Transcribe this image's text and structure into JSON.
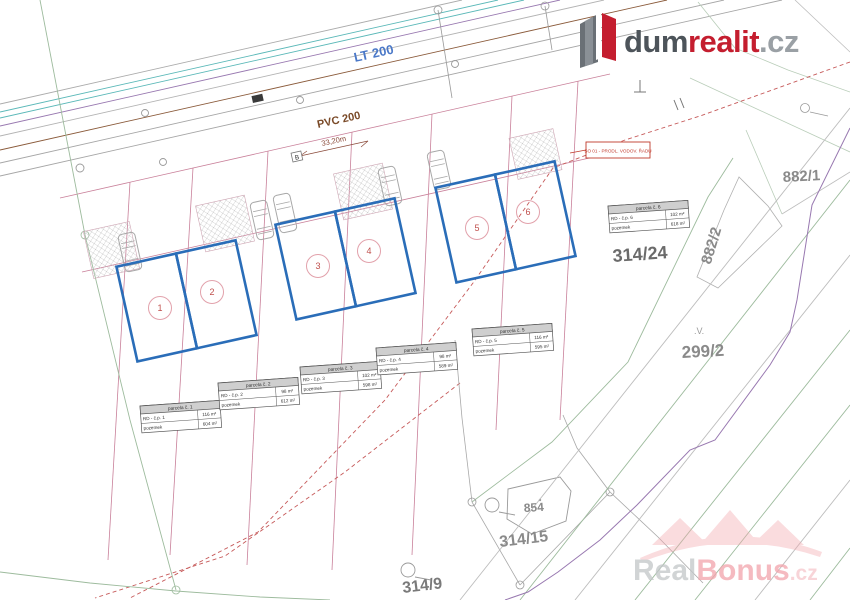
{
  "map": {
    "road_labels": {
      "water_main": "LT 200",
      "sewer_main": "PVC 200",
      "dimension": "33,20m",
      "point_b": "B"
    },
    "red_note": "SO 01 - PRODL. VODOV. ŘADU",
    "parcels": {
      "p882_1": "882/1",
      "p882_2": "882/2",
      "p314_24": "314/24",
      "p299_2": "299/2",
      "p854": "854",
      "p314_15": "314/15",
      "p314_9": "314/9",
      "marker_v": ".V."
    },
    "units": [
      "1",
      "2",
      "3",
      "4",
      "5",
      "6"
    ],
    "tables": [
      {
        "header": "parcela č. 1",
        "rows": [
          [
            "RD - č.p. 1",
            "116 m²"
          ],
          [
            "pozemek",
            "604 m²"
          ]
        ]
      },
      {
        "header": "parcela č. 2",
        "rows": [
          [
            "RD - č.p. 2",
            "98 m²"
          ],
          [
            "pozemek",
            "612 m²"
          ]
        ]
      },
      {
        "header": "parcela č. 3",
        "rows": [
          [
            "RD - č.p. 3",
            "102 m²"
          ],
          [
            "pozemek",
            "598 m²"
          ]
        ]
      },
      {
        "header": "parcela č. 4",
        "rows": [
          [
            "RD - č.p. 4",
            "98 m²"
          ],
          [
            "pozemek",
            "589 m²"
          ]
        ]
      },
      {
        "header": "parcela č. 5",
        "rows": [
          [
            "RD - č.p. 5",
            "116 m²"
          ],
          [
            "pozemek",
            "595 m²"
          ]
        ]
      },
      {
        "header": "parcela č. 6",
        "rows": [
          [
            "RD - č.p. 6",
            "102 m²"
          ],
          [
            "pozemek",
            "618 m²"
          ]
        ]
      }
    ]
  },
  "branding": {
    "logo": {
      "part1": "dum",
      "part2": "realit",
      "part3": ".cz"
    },
    "watermark": {
      "part1": "Real",
      "part2": "Bonus",
      "part3": ".cz"
    }
  },
  "colors": {
    "house_blue": "#2a6db8",
    "parcel_pink": "#c9809a",
    "dashed_red": "#c65a5a",
    "water_teal": "#5ab8b8",
    "sewer_brown": "#8a5a3a",
    "utility_purple": "#9878b0",
    "boundary_green": "#9dbb9d",
    "logo_red": "#c41e2f",
    "logo_gray": "#4d545a",
    "watermark_pink": "#f2a3ab"
  }
}
